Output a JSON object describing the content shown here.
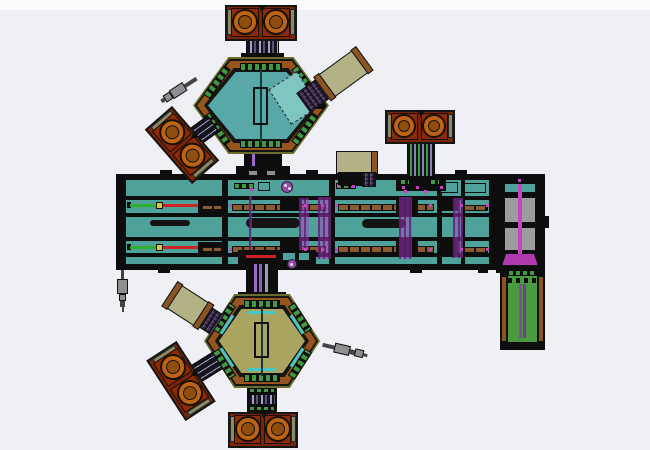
{
  "scene": {
    "type": "cad-top-view-drawing",
    "clusters_visible": 2
  },
  "colors": {
    "bg": "#eef0f6",
    "bg_top_strip": "#fbfcfe",
    "teal": "#4fa29a",
    "teal_light": "#7fc6c2",
    "hex_teal": "#57a8a6",
    "hex_olive_interior": "#a9a45f",
    "ring_olive": "#6b6b2d",
    "corner_sienna": "#96551c",
    "slot_green": "#3f9945",
    "cyan": "#45c8c8",
    "chamber_body": "#7b2507",
    "chamber_pan": "#8a2c09",
    "chamber_ring": "#bd6314",
    "chamber_hub": "#8f4e0e",
    "cap_olive": "#8a8a64",
    "tan_panel": "#b2b286",
    "brown_bar": "#8a5524",
    "rail_brown": "#8a5a30",
    "magenta": "#c544c5",
    "violet_line": "#9a6ac8",
    "rod_green": "#2fae2f",
    "rod_red": "#cc2222",
    "rod_yellow": "#d8c832",
    "gray_block": "#9c9c9c",
    "wand_gray": "#8f8f8f",
    "green_module": "#4a9a40"
  },
  "dual_chamber_modules": [
    {
      "id": "upper-cluster-top-chamber",
      "x": 225,
      "y": 5,
      "w": 72,
      "h": 36,
      "rot": 0
    },
    {
      "id": "upper-cluster-lowerleft-chamber",
      "x": 146,
      "y": 127,
      "w": 72,
      "h": 36,
      "rot": 49
    },
    {
      "id": "platform-top-right-chamber",
      "x": 385,
      "y": 110,
      "w": 70,
      "h": 34,
      "rot": 0
    },
    {
      "id": "lower-cluster-bottom-chamber",
      "x": 228,
      "y": 412,
      "w": 70,
      "h": 36,
      "rot": 0
    },
    {
      "id": "lower-cluster-lowerleft-chamber",
      "x": 145,
      "y": 363,
      "w": 72,
      "h": 36,
      "rot": 57
    }
  ]
}
